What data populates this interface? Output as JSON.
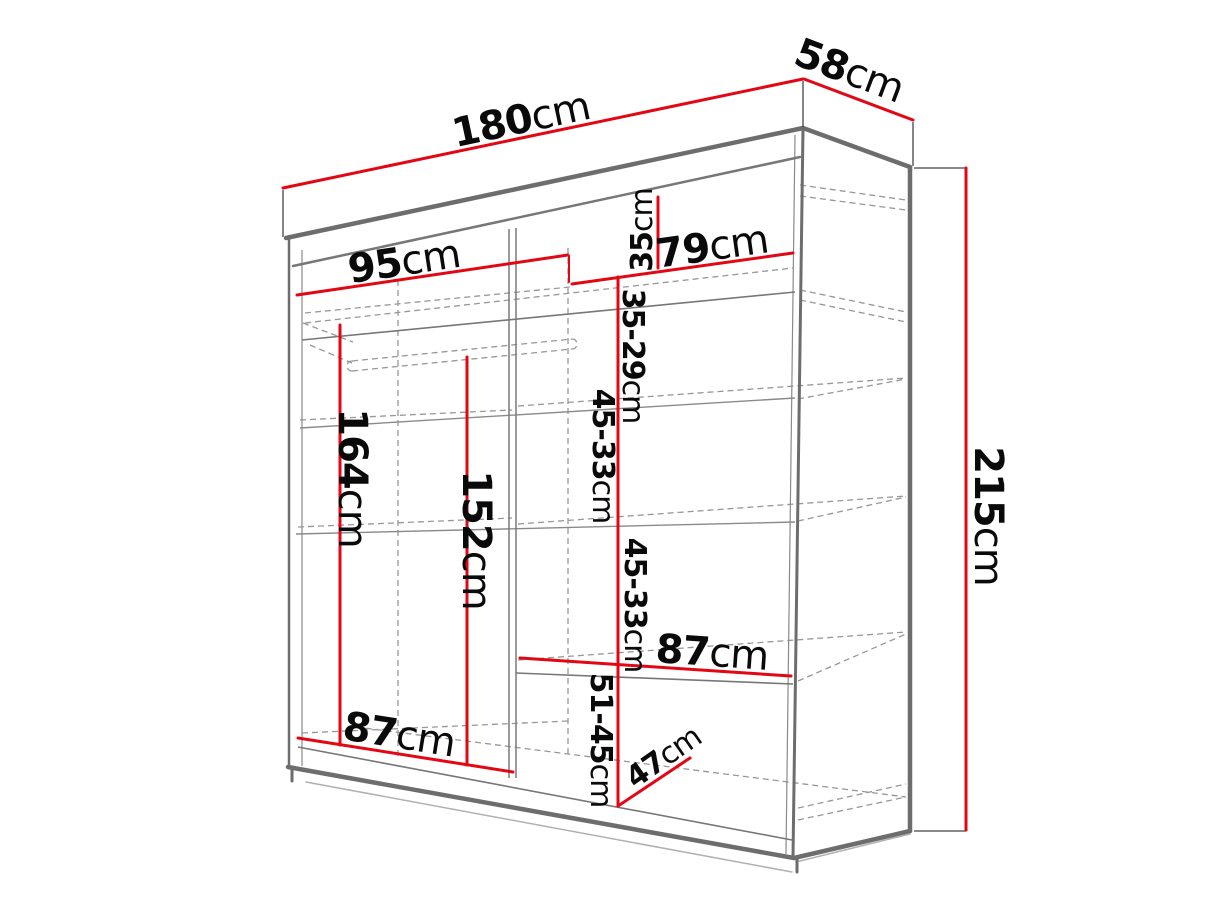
{
  "figure": {
    "kind": "wardrobe-dimension-diagram",
    "background_color": "#ffffff",
    "dimension_line_color": "#e30613",
    "outline_color": "#6d6d6d",
    "hidden_line_color": "#979797",
    "text_color": "#0a0a0a"
  },
  "dimensions": {
    "width": {
      "value": "180",
      "unit": "cm"
    },
    "depth": {
      "value": "58",
      "unit": "cm"
    },
    "height": {
      "value": "215",
      "unit": "cm"
    },
    "left_width": {
      "value": "95",
      "unit": "cm"
    },
    "right_width": {
      "value": "79",
      "unit": "cm"
    },
    "top_shelf": {
      "value": "35",
      "unit": "cm"
    },
    "upper_gap": {
      "value": "35-29",
      "unit": "cm"
    },
    "hanging_height": {
      "value": "164",
      "unit": "cm"
    },
    "rail_height": {
      "value": "152",
      "unit": "cm"
    },
    "gap_1": {
      "value": "45-33",
      "unit": "cm"
    },
    "gap_2": {
      "value": "45-33",
      "unit": "cm"
    },
    "right_shelf_width": {
      "value": "87",
      "unit": "cm"
    },
    "bottom_left_width": {
      "value": "87",
      "unit": "cm"
    },
    "bottom_gap": {
      "value": "51-45",
      "unit": "cm"
    },
    "bottom_depth": {
      "value": "47",
      "unit": "cm"
    }
  }
}
